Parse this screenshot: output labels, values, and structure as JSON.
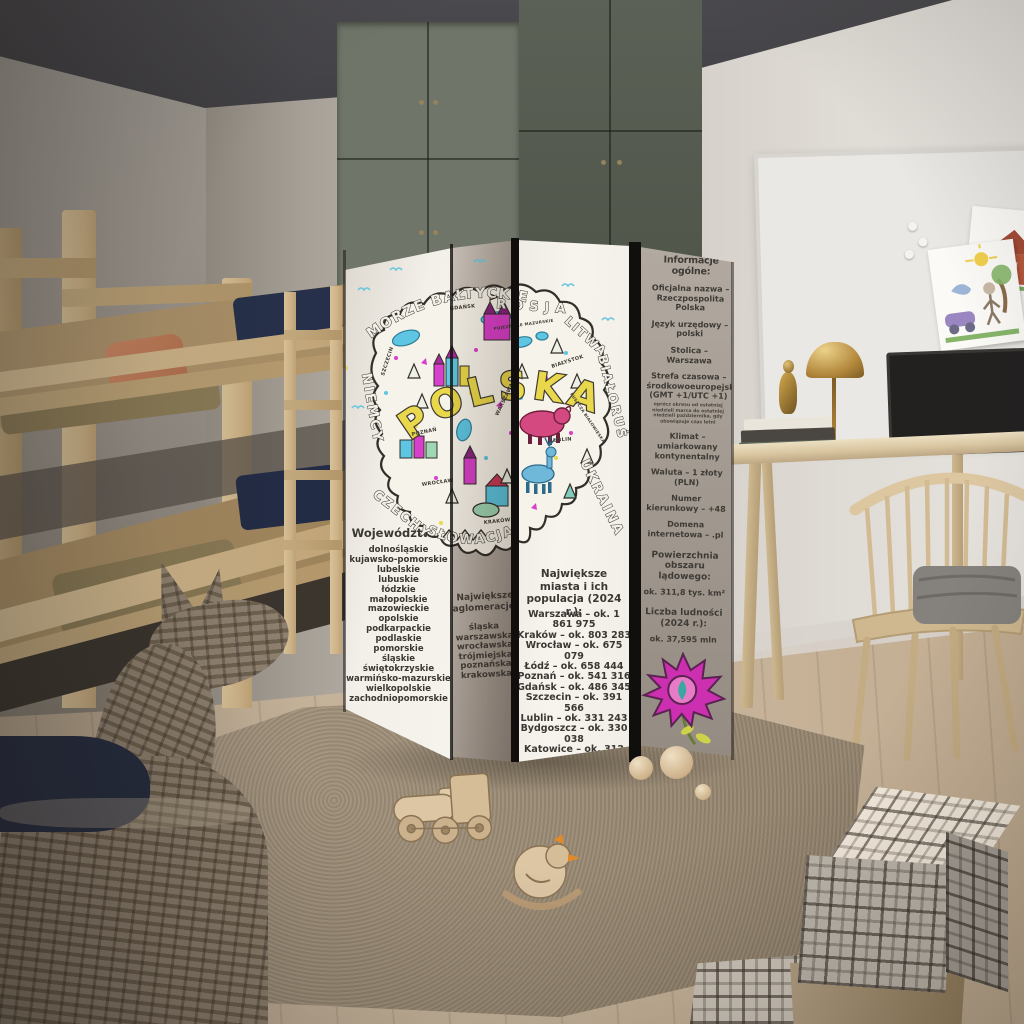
{
  "screen": {
    "wojewodztwa": {
      "header": "Województwa:",
      "items": [
        "dolnośląskie",
        "kujawsko-pomorskie",
        "lubelskie",
        "lubuskie",
        "łódzkie",
        "małopolskie",
        "mazowieckie",
        "opolskie",
        "podkarpackie",
        "podlaskie",
        "pomorskie",
        "śląskie",
        "świętokrzyskie",
        "warmińsko-mazurskie",
        "wielkopolskie",
        "zachodniopomorskie"
      ]
    },
    "aglomeracje": {
      "header": "Największe aglomeracje:",
      "items": [
        "śląska",
        "warszawska",
        "wrocławska",
        "trójmiejska",
        "poznańska",
        "krakowska"
      ]
    },
    "miasta": {
      "header": "Największe miasta i ich populacja (2024 r.):",
      "items": [
        "Warszawa – ok. 1 861 975",
        "Kraków – ok. 803 283",
        "Wrocław – ok. 675 079",
        "Łódź – ok. 658 444",
        "Poznań – ok. 541 316",
        "Gdańsk – ok. 486 345",
        "Szczecin – ok. 391 566",
        "Lublin – ok. 331 243",
        "Bydgoszcz – ok. 330 038",
        "Katowice – ok. 312 000",
        "Białystok – ok. 292 600"
      ]
    },
    "info": {
      "header": "Informacje ogólne:",
      "facts_a": [
        "Oficjalna nazwa – Rzeczpospolita Polska",
        "Język urzędowy – polski",
        "Stolica – Warszawa",
        "Strefa czasowa – środkowoeuropejska (GMT +1/UTC +1)"
      ],
      "fine_print": "oprócz okresu od ostatniej niedzieli marca do ostatniej niedzieli października, gdy obowiązuje czas letni",
      "facts_b": [
        "Klimat – umiarkowany kontynentalny",
        "Waluta – 1 złoty (PLN)",
        "Numer kierunkowy – +48",
        "Domena internetowa – .pl"
      ],
      "area_header": "Powierzchnia obszaru lądowego:",
      "area_value": "ok. 311,8 tys. km²",
      "population_header": "Liczba ludności (2024 r.):",
      "population_value": "ok. 37,595 mln"
    },
    "map": {
      "country": "POLSKA",
      "sea": "MORZE BAŁTYCKIE",
      "neighbors": [
        "ROSJA",
        "LITWA",
        "BIAŁORUŚ",
        "UKRAINA",
        "SŁOWACJA",
        "CZECHY",
        "NIEMCY"
      ],
      "places": [
        "SZCZECIN",
        "GDAŃSK",
        "POZNAŃ",
        "WARSZAWA",
        "WROCŁAW",
        "KRAKÓW",
        "LUBLIN",
        "BIAŁYSTOK",
        "POJEZIERZE MAZURSKIE",
        "PUSZCZA BIAŁOWIESKA"
      ]
    }
  },
  "colors": {
    "map_magenta": "#d83fca",
    "map_cyan": "#5ec6e2",
    "map_yellow": "#e9d84b",
    "bison_pink": "#d4497f",
    "deer_blue": "#6fb8da",
    "flower_magenta": "#cc2fb0",
    "panel_light": "#f3f0e9",
    "text_dark": "#3b3733"
  }
}
